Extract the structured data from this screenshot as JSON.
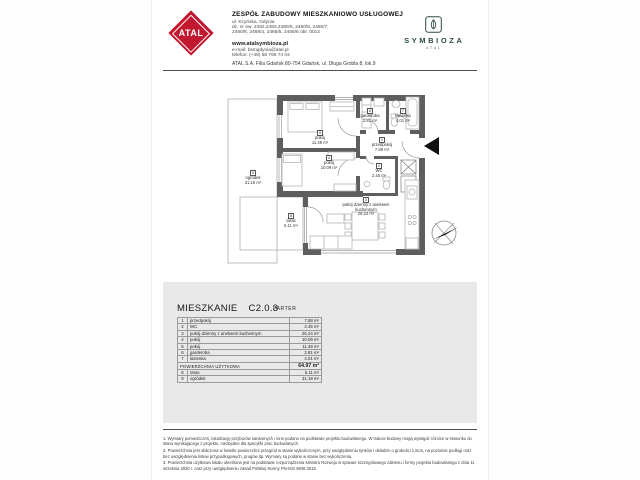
{
  "header": {
    "project_title": "ZESPÓŁ ZABUDOWY MIESZKANIOWO USŁUGOWEJ",
    "address_line1": "ul. Kcyńska, Gdynia",
    "address_line2": "dz. nr ew. 2482,2483,2480/5, 2480/6, 2480/7,",
    "address_line3": "2480/8, 2468/4, 2468/5, 2468/6  obr. 0012",
    "website": "www.atalsymbioza.pl",
    "email_line": "e-mail: bsmgdynia@atal.pl",
    "phone_line": "telefon: (+48) 58 766 74 04",
    "branch_line": "ATAL S.A. Filia Gdańsk 80-754 Gdańsk, ul. Długa Grobla 8, lok.9"
  },
  "logos": {
    "atal": "ATAL",
    "symbioza": "SYMBIOZA",
    "symbioza_sub": "ATAL"
  },
  "apartment": {
    "label": "MIESZKANIE",
    "unit": "C2.0.3",
    "floor": "PARTER",
    "rows": [
      {
        "no": "1",
        "name": "przedpokój",
        "area": "7.88 m²"
      },
      {
        "no": "2",
        "name": "WC",
        "area": "2.45 m²"
      },
      {
        "no": "3",
        "name": "pokój dzienny z aneksem kuchennym",
        "area": "26.24 m²"
      },
      {
        "no": "4",
        "name": "pokój",
        "area": "10.09 m²"
      },
      {
        "no": "5",
        "name": "pokój",
        "area": "11.49 m²"
      },
      {
        "no": "6",
        "name": "garderoba",
        "area": "2.81 m²"
      },
      {
        "no": "7",
        "name": "łazienka",
        "area": "4.01 m²"
      }
    ],
    "total_label": "POWIERZCHNIA UŻYTKOWA",
    "total_area": "64.97 m²",
    "outdoor_rows": [
      {
        "no": "8",
        "name": "taras",
        "area": "6.11 m²"
      },
      {
        "no": "9",
        "name": "ogródek",
        "area": "31.18 m²"
      }
    ]
  },
  "plan": {
    "living_room_name_line1": "pokój dzienny z aneksem",
    "living_room_name_line2": "kuchennym"
  },
  "footnotes": {
    "n1": "1.  Wymiary pomieszczeń, lokalizację przyborów sanitarnych i inne podano na podstawie projektu budowlanego. W trakcie budowy mogą wystąpić różnice w stosunku do stanu wynikającego z projektu, niezbędne dla specyfiki prac budowlanych.",
    "n2": "2.  Powierzchnia jest obliczona w świetle powierzchni przegród w stanie wykończonym, przy uwzględnieniu tynków i okładzin o grubości 1,5cm, na poziomie podłogi oraz bez uwzględnienia listew przypodłogowych, progów itp. Wymiary są podane w stanie bez wykończenia.",
    "n3": "3.  Powierzchnia użytkowa lokalu określona jest na podstawie rozporządzenia Ministra Rozwoju w sprawie szczegółowego zakresu i formy projektu budowlanego z dnia 11 września 2020 r. oraz przy uwzględnieniu zasad Polskiej Normy PN-ISO 9836:2015."
  },
  "colors": {
    "atal_red": "#c2182f",
    "symbioza_green": "#2e4b43",
    "wall_gray": "#5e5e5e",
    "unit_highlight": "#cc3b3b",
    "panel_gray": "#e9e9e9"
  }
}
